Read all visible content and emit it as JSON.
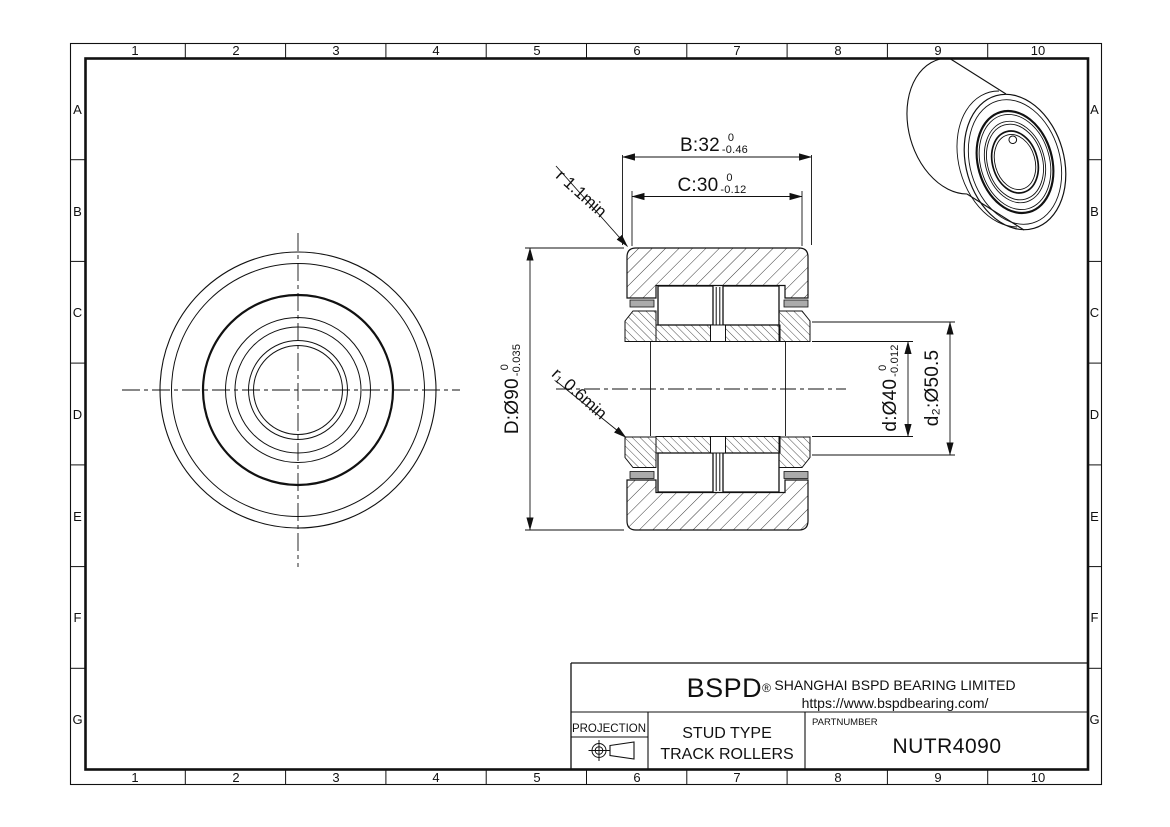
{
  "drawing": {
    "grid": {
      "columns": [
        "1",
        "2",
        "3",
        "4",
        "5",
        "6",
        "7",
        "8",
        "9",
        "10"
      ],
      "rows": [
        "A",
        "B",
        "C",
        "D",
        "E",
        "F",
        "G"
      ]
    },
    "dimensions": {
      "B": {
        "label": "B:32",
        "tol_upper": "0",
        "tol_lower": "-0.46"
      },
      "C": {
        "label": "C:30",
        "tol_upper": "0",
        "tol_lower": "-0.12"
      },
      "D": {
        "label": "D:Ø90",
        "tol_upper": "0",
        "tol_lower": "-0.035"
      },
      "d": {
        "label": "d:Ø40",
        "tol_upper": "0",
        "tol_lower": "-0.012"
      },
      "d2": {
        "label": "d₂:Ø50.5"
      },
      "r": {
        "label": "r 1.1min"
      },
      "r1": {
        "label": "r₁ 0.6min"
      }
    },
    "title_block": {
      "brand": "BSPD",
      "brand_mark": "®",
      "company": "SHANGHAI BSPD BEARING LIMITED",
      "website": "https://www.bspdbearing.com/",
      "projection_label": "PROJECTION",
      "product_type_line1": "STUD TYPE",
      "product_type_line2": "TRACK ROLLERS",
      "part_number_label": "PARTNUMBER",
      "part_number": "NUTR4090"
    }
  }
}
